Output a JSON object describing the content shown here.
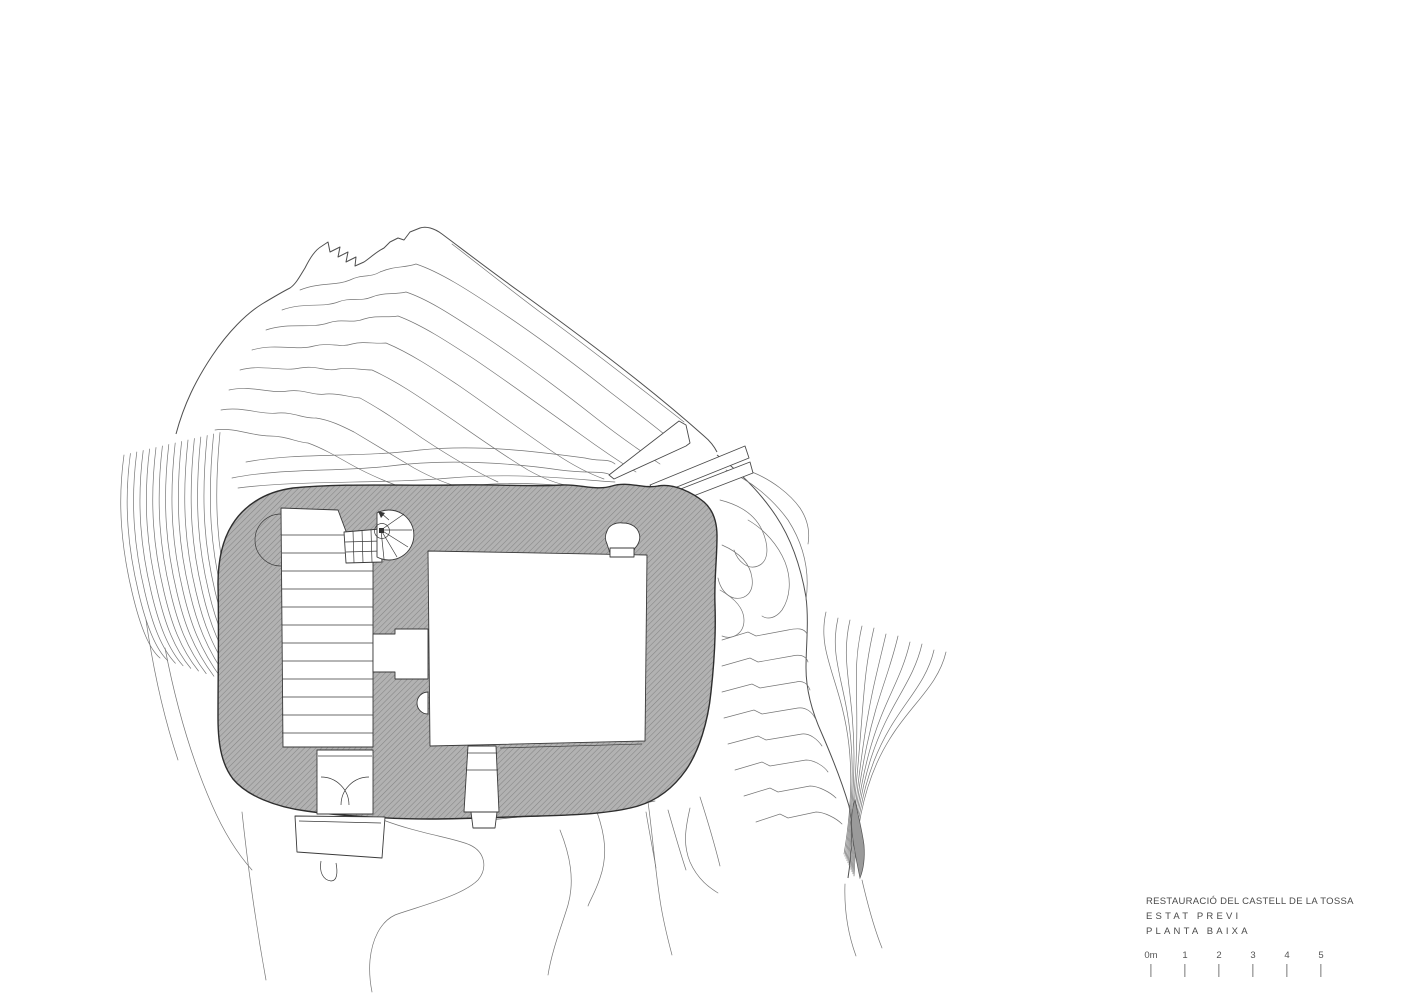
{
  "title_block": {
    "line1": "RESTAURACIÓ DEL CASTELL DE LA TOSSA",
    "line2": "ESTAT PREVI",
    "line3": "PLANTA BAIXA"
  },
  "scale_bar": {
    "labels": [
      "0m",
      "1",
      "2",
      "3",
      "4",
      "5"
    ]
  },
  "colors": {
    "paper": "#ffffff",
    "ink": "#3c3c3c",
    "contour": "#757575",
    "outline": "#4f4f4f",
    "hatch_fill": "#b2b2b2",
    "hatch_line": "#858585",
    "sliver_fill": "#9a9a9a",
    "wall_edge": "#2e2e2e"
  }
}
